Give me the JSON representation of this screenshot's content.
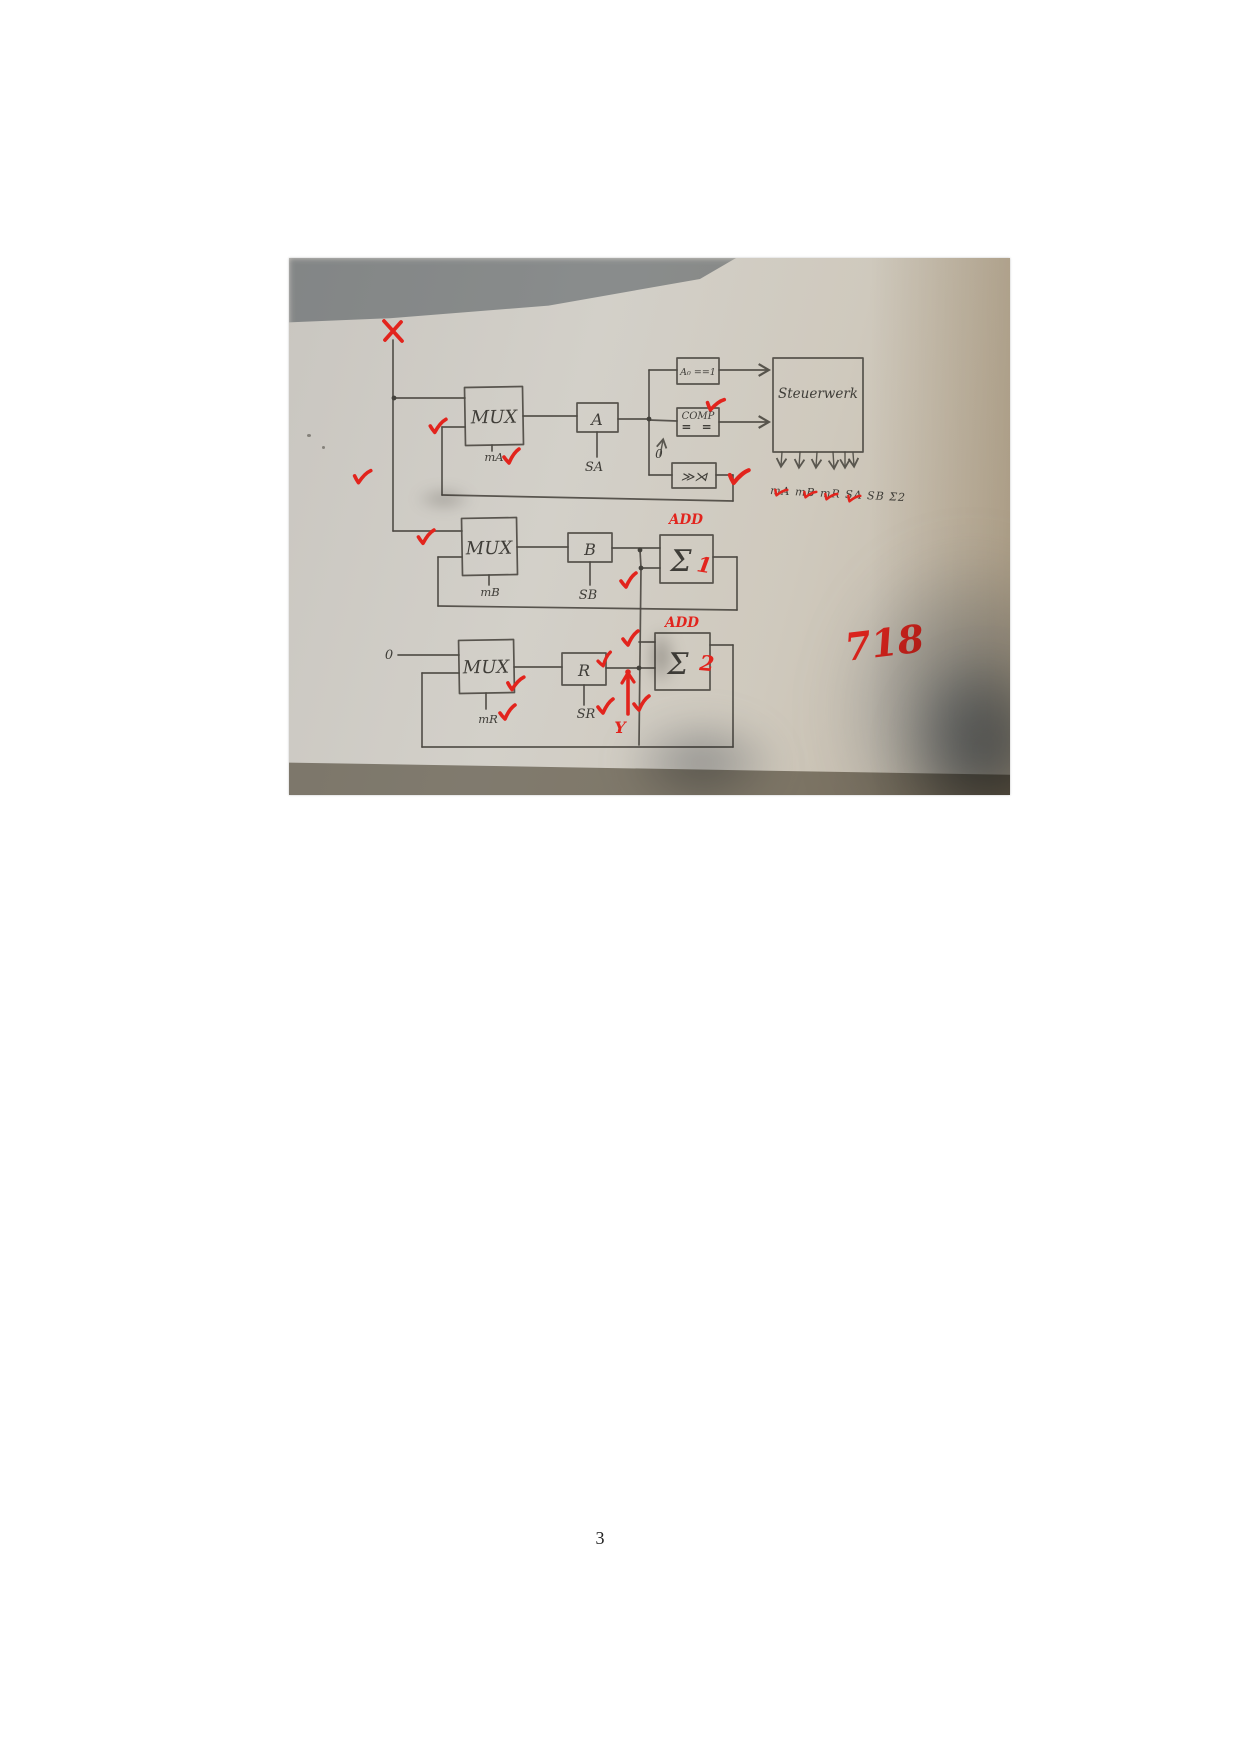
{
  "page": {
    "number": "3"
  },
  "photo": {
    "annotations": {
      "x_mark": "X",
      "y_mark": "Y",
      "grade": "718",
      "add": "ADD",
      "sum1_index": "1",
      "sum2_index": "2"
    },
    "inputs": {
      "zero": "0"
    },
    "blocks": {
      "mux": "MUX",
      "reg_a": "A",
      "reg_b": "B",
      "reg_r": "R",
      "a0": "A₀ ==1",
      "comp": "COMP",
      "comp_eq": "= =",
      "shift": "≫⋊",
      "control": "Steuerwerk",
      "sum": "Σ"
    },
    "signals": {
      "ma": "mA",
      "sa": "SA",
      "mb": "mB",
      "sb": "SB",
      "mr": "mR",
      "sr": "SR"
    },
    "control_caption": "mA mB mR SA SB Σ2"
  }
}
